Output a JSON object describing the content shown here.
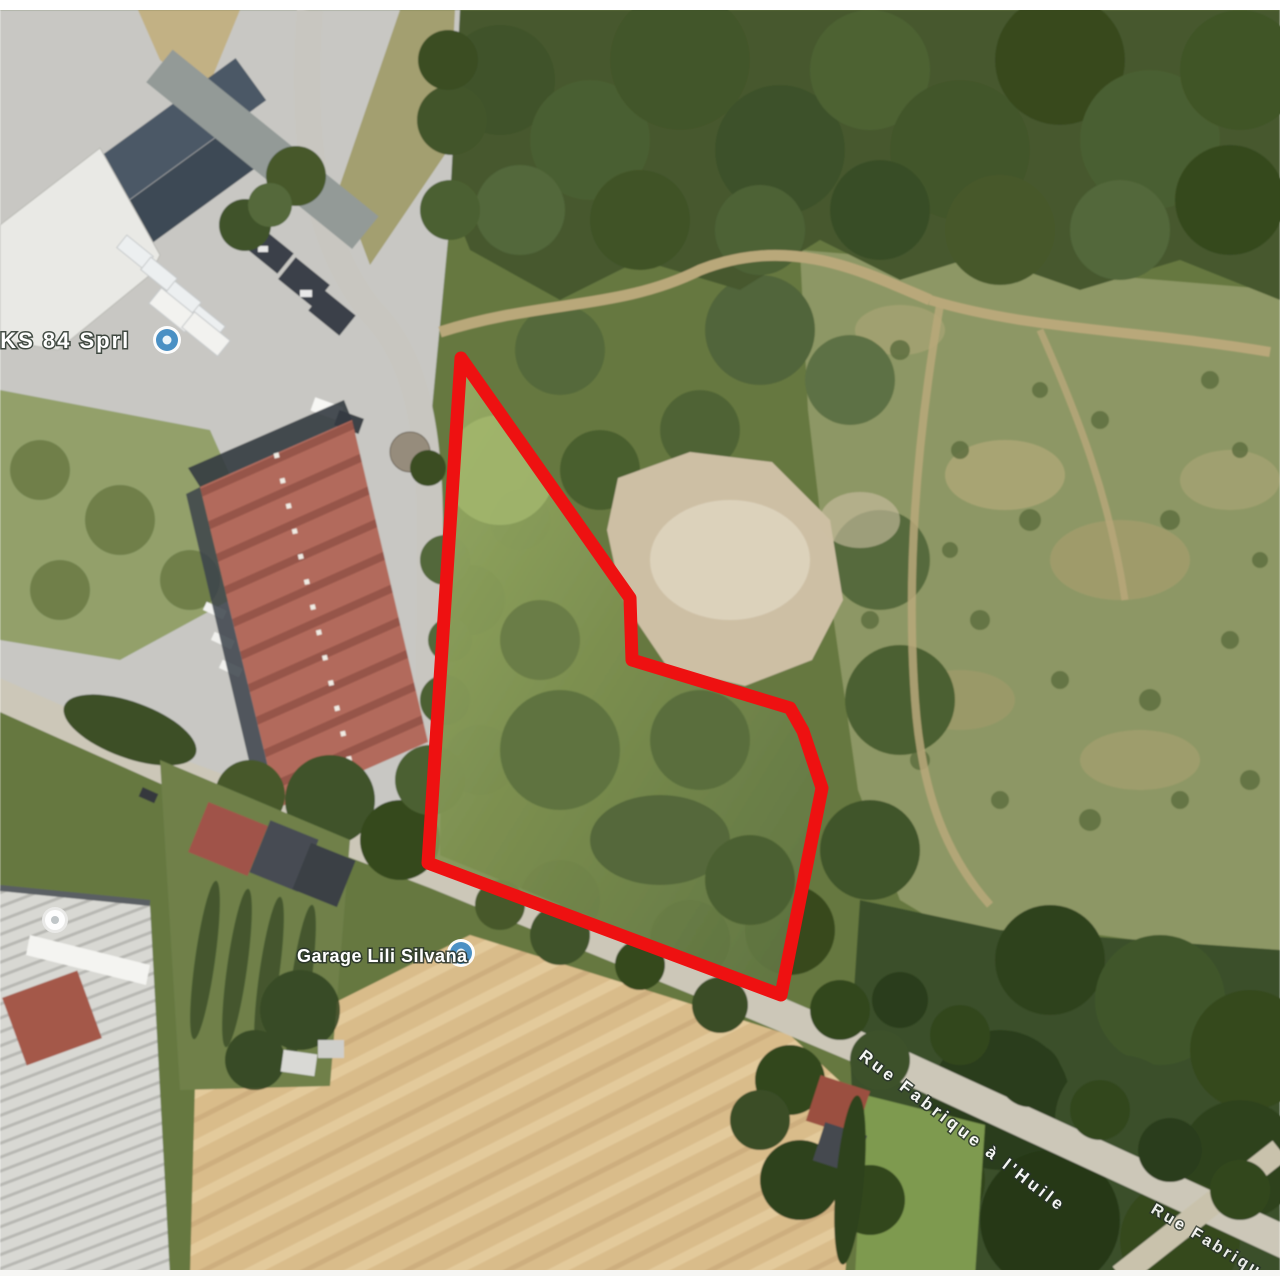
{
  "map": {
    "description": "Aerial satellite photo with a land parcel outlined in red",
    "labels": {
      "poi_partial": "2KS 84 Sprl",
      "poi_garage": "Garage Lili Silvana",
      "road_main": "Rue Fabrique à l'Huile",
      "road_corner": "Rue Fabriqu"
    },
    "pins": [
      {
        "name": "poi-pin-partial",
        "type": "blue-poi",
        "transform": "translate(167,340)"
      },
      {
        "name": "poi-pin-garage",
        "type": "blue-poi",
        "transform": "translate(461,953)"
      },
      {
        "name": "poi-pin-white",
        "type": "white-poi",
        "transform": "translate(55,920)"
      }
    ],
    "parcel": {
      "outline_color": "#ee1111",
      "stroke_width": 13,
      "points": "461,358 630,598 632,660 790,708 803,731 822,788 781,995 428,863"
    },
    "colors": {
      "forest_dark": "#44582e",
      "woodland_mid": "#66783f",
      "scrub_hillside": "#8d9765",
      "field_tan": "#d9bc8a",
      "pavement_gray": "#c8c7c3",
      "road_tan": "#ccc7b8",
      "warehouse_red_roof": "#b26a5b",
      "margin_white": "#ffffff"
    }
  }
}
